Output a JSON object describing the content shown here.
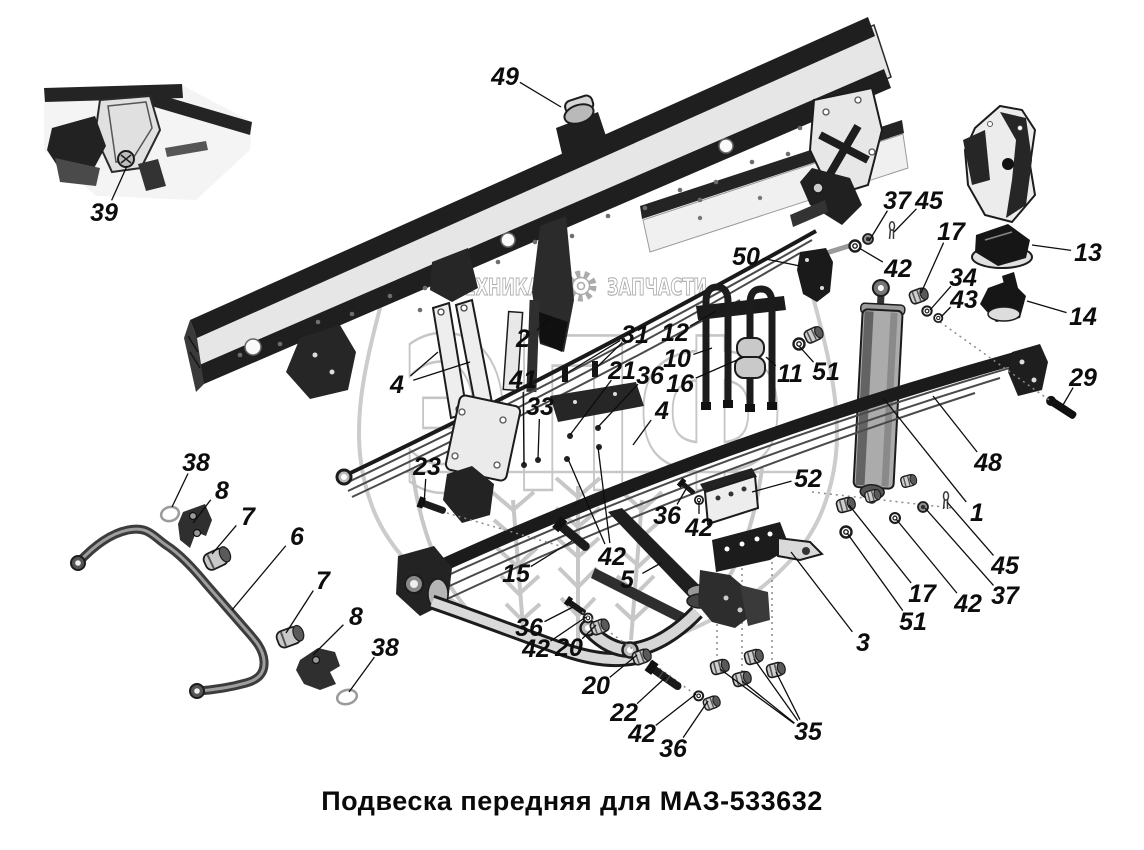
{
  "title": "Подвеска передняя для МАЗ-533632",
  "watermark": {
    "left_text": "ТЕХНИКА",
    "right_text": "ЗАПЧАСТИ",
    "big_text": "ЭПФ",
    "color": "#c6c6c6"
  },
  "colors": {
    "ink": "#0d0d0d",
    "metal_dark": "#1e1e1e",
    "metal_mid": "#8f8f8f",
    "metal_light": "#e8e8e8",
    "background": "#ffffff"
  },
  "callouts": [
    {
      "label": "49",
      "x": 505,
      "y": 76,
      "targets": [
        [
          561,
          107
        ]
      ]
    },
    {
      "label": "39",
      "x": 104,
      "y": 212,
      "targets": [
        [
          127,
          166
        ]
      ]
    },
    {
      "label": "37",
      "x": 897,
      "y": 200,
      "targets": [
        [
          869,
          241
        ]
      ]
    },
    {
      "label": "45",
      "x": 929,
      "y": 200,
      "targets": [
        [
          894,
          232
        ]
      ]
    },
    {
      "label": "42",
      "x": 898,
      "y": 268,
      "targets": [
        [
          859,
          248
        ]
      ]
    },
    {
      "label": "17",
      "x": 951,
      "y": 231,
      "targets": [
        [
          921,
          293
        ]
      ]
    },
    {
      "label": "34",
      "x": 963,
      "y": 277,
      "targets": [
        [
          930,
          310
        ]
      ]
    },
    {
      "label": "43",
      "x": 964,
      "y": 299,
      "targets": [
        [
          941,
          317
        ]
      ]
    },
    {
      "label": "13",
      "x": 1088,
      "y": 252,
      "targets": [
        [
          1032,
          245
        ]
      ]
    },
    {
      "label": "14",
      "x": 1083,
      "y": 316,
      "targets": [
        [
          1027,
          301
        ]
      ]
    },
    {
      "label": "29",
      "x": 1083,
      "y": 377,
      "targets": [
        [
          1063,
          405
        ]
      ]
    },
    {
      "label": "50",
      "x": 746,
      "y": 256,
      "targets": [
        [
          800,
          266
        ]
      ]
    },
    {
      "label": "2",
      "x": 523,
      "y": 338,
      "targets": [
        [
          549,
          319
        ]
      ]
    },
    {
      "label": "31",
      "x": 635,
      "y": 334,
      "targets": [
        [
          567,
          373
        ],
        [
          596,
          368
        ]
      ]
    },
    {
      "label": "12",
      "x": 675,
      "y": 332,
      "targets": [
        [
          716,
          311
        ]
      ]
    },
    {
      "label": "10",
      "x": 677,
      "y": 358,
      "targets": [
        [
          712,
          348
        ]
      ]
    },
    {
      "label": "16",
      "x": 680,
      "y": 383,
      "targets": [
        [
          744,
          357
        ]
      ]
    },
    {
      "label": "11",
      "x": 790,
      "y": 373,
      "targets": [
        [
          766,
          357
        ]
      ]
    },
    {
      "label": "51",
      "x": 826,
      "y": 371,
      "targets": [
        [
          799,
          346
        ]
      ]
    },
    {
      "label": "41",
      "x": 523,
      "y": 379,
      "targets": [
        [
          524,
          464
        ]
      ]
    },
    {
      "label": "33",
      "x": 540,
      "y": 406,
      "targets": [
        [
          538,
          459
        ]
      ]
    },
    {
      "label": "21",
      "x": 622,
      "y": 370,
      "targets": [
        [
          570,
          435
        ]
      ]
    },
    {
      "label": "36",
      "x": 650,
      "y": 375,
      "targets": [
        [
          598,
          427
        ]
      ]
    },
    {
      "label": "4",
      "x": 397,
      "y": 384,
      "targets": [
        [
          438,
          352
        ],
        [
          470,
          362
        ]
      ]
    },
    {
      "label": "4",
      "x": 662,
      "y": 410,
      "targets": [
        [
          633,
          445
        ]
      ]
    },
    {
      "label": "23",
      "x": 427,
      "y": 466,
      "targets": [
        [
          424,
          505
        ]
      ]
    },
    {
      "label": "15",
      "x": 516,
      "y": 573,
      "targets": [
        [
          572,
          541
        ]
      ]
    },
    {
      "label": "42",
      "x": 612,
      "y": 556,
      "targets": [
        [
          568,
          459
        ],
        [
          598,
          447
        ]
      ]
    },
    {
      "label": "5",
      "x": 627,
      "y": 579,
      "targets": [
        [
          661,
          563
        ]
      ]
    },
    {
      "label": "36",
      "x": 529,
      "y": 627,
      "targets": [
        [
          573,
          607
        ]
      ]
    },
    {
      "label": "42",
      "x": 536,
      "y": 648,
      "targets": [
        [
          586,
          617
        ]
      ]
    },
    {
      "label": "20",
      "x": 569,
      "y": 647,
      "targets": [
        [
          596,
          625
        ]
      ]
    },
    {
      "label": "20",
      "x": 596,
      "y": 685,
      "targets": [
        [
          637,
          655
        ]
      ]
    },
    {
      "label": "22",
      "x": 624,
      "y": 712,
      "targets": [
        [
          666,
          677
        ]
      ]
    },
    {
      "label": "42",
      "x": 642,
      "y": 733,
      "targets": [
        [
          696,
          694
        ]
      ]
    },
    {
      "label": "36",
      "x": 673,
      "y": 748,
      "targets": [
        [
          708,
          701
        ]
      ]
    },
    {
      "label": "35",
      "x": 808,
      "y": 731,
      "targets": [
        [
          720,
          669
        ],
        [
          742,
          681
        ],
        [
          754,
          659
        ],
        [
          776,
          672
        ]
      ]
    },
    {
      "label": "3",
      "x": 863,
      "y": 642,
      "targets": [
        [
          791,
          552
        ]
      ]
    },
    {
      "label": "52",
      "x": 808,
      "y": 478,
      "targets": [
        [
          752,
          492
        ]
      ]
    },
    {
      "label": "48",
      "x": 988,
      "y": 462,
      "targets": [
        [
          933,
          396
        ]
      ]
    },
    {
      "label": "1",
      "x": 977,
      "y": 512,
      "targets": [
        [
          884,
          399
        ]
      ]
    },
    {
      "label": "45",
      "x": 1005,
      "y": 565,
      "targets": [
        [
          947,
          502
        ]
      ]
    },
    {
      "label": "37",
      "x": 1005,
      "y": 595,
      "targets": [
        [
          925,
          508
        ]
      ]
    },
    {
      "label": "42",
      "x": 968,
      "y": 603,
      "targets": [
        [
          896,
          519
        ]
      ]
    },
    {
      "label": "17",
      "x": 922,
      "y": 593,
      "targets": [
        [
          849,
          505
        ]
      ]
    },
    {
      "label": "51",
      "x": 913,
      "y": 621,
      "targets": [
        [
          847,
          533
        ]
      ]
    },
    {
      "label": "36",
      "x": 667,
      "y": 515,
      "targets": [
        [
          686,
          489
        ]
      ]
    },
    {
      "label": "42",
      "x": 699,
      "y": 527,
      "targets": [
        [
          699,
          501
        ]
      ]
    },
    {
      "label": "38",
      "x": 196,
      "y": 462,
      "targets": [
        [
          172,
          507
        ]
      ]
    },
    {
      "label": "8",
      "x": 222,
      "y": 490,
      "targets": [
        [
          193,
          523
        ]
      ]
    },
    {
      "label": "7",
      "x": 248,
      "y": 516,
      "targets": [
        [
          212,
          554
        ]
      ]
    },
    {
      "label": "6",
      "x": 297,
      "y": 536,
      "targets": [
        [
          232,
          610
        ]
      ]
    },
    {
      "label": "7",
      "x": 323,
      "y": 580,
      "targets": [
        [
          286,
          633
        ]
      ]
    },
    {
      "label": "8",
      "x": 356,
      "y": 616,
      "targets": [
        [
          313,
          655
        ]
      ]
    },
    {
      "label": "38",
      "x": 385,
      "y": 647,
      "targets": [
        [
          349,
          692
        ]
      ]
    }
  ]
}
